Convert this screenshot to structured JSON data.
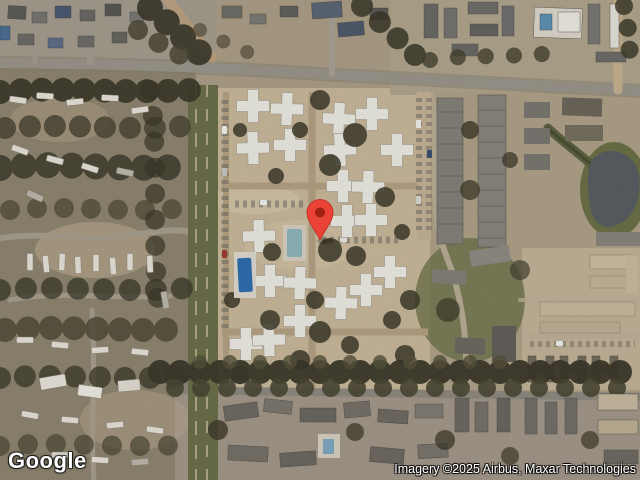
{
  "app": {
    "name": "Google Maps satellite view"
  },
  "map": {
    "view_type": "satellite",
    "marker": {
      "transform": "translate(320,240)",
      "color": "#EA4335",
      "outline_color": "#C0291F",
      "dot_color": "#A02011"
    },
    "palette": {
      "ground_tan": "#ac9f88",
      "complex_tan": "#c9b89b",
      "road_gray": "#9b968c",
      "tree_dark": "#3b382a",
      "grass_green": "#6b6f4a",
      "building_white": "#ecebe4",
      "roof_gray": "#74716b",
      "pool_blue": "#2f6fae",
      "pond_gray": "#585e63"
    }
  },
  "watermark": {
    "logo": "Google",
    "attribution": "Imagery ©2025 Airbus, Maxar Technologies"
  }
}
